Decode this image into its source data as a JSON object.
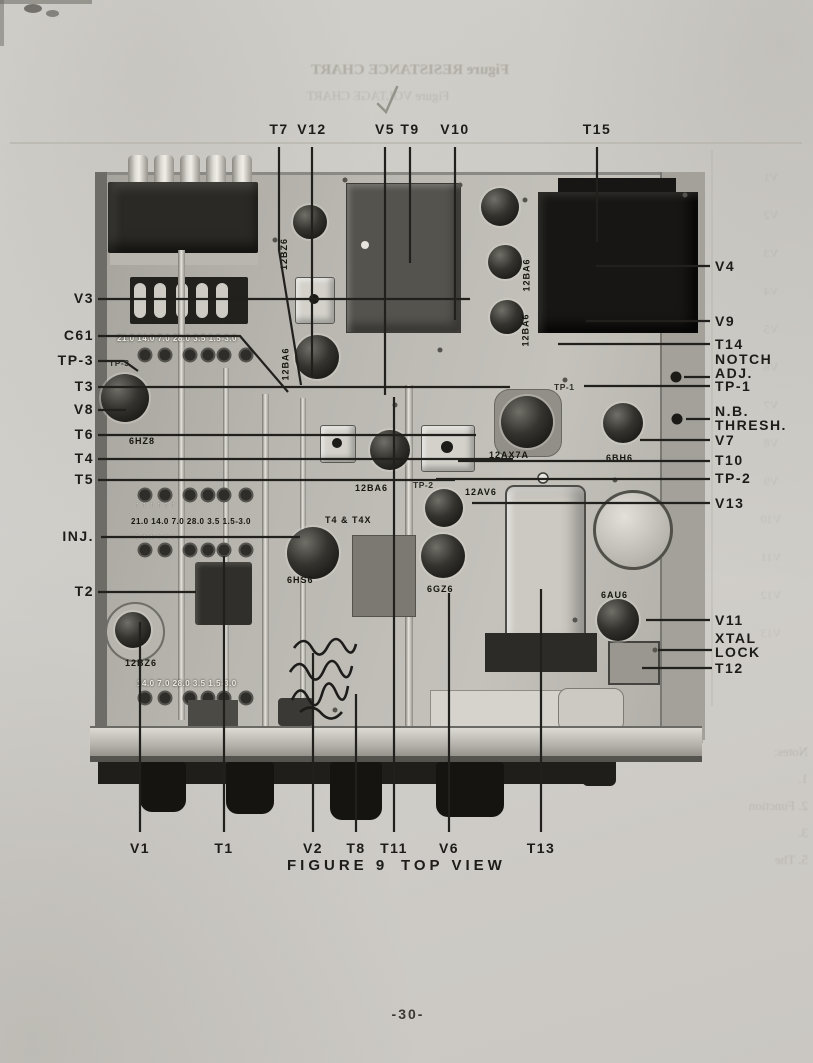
{
  "page": {
    "number": "-30-",
    "caption": {
      "figure": "FIGURE 9",
      "view": "TOP VIEW"
    }
  },
  "bleedthrough": {
    "title1": "Figure    RESISTANCE CHART",
    "title2": "Figure    VOLTAGE CHART",
    "notes": "Notes:\n1.\n2.  Function\n3.\n5.  The",
    "tube_column": "V1\nV2\nV3\nV4\nV5\nV6\nV7\nV8\nV9\nV10\nV11\nV12\nV13"
  },
  "callouts": {
    "top": [
      {
        "label": "T7"
      },
      {
        "label": "V12"
      },
      {
        "label": "V5"
      },
      {
        "label": "T9"
      },
      {
        "label": "V10"
      },
      {
        "label": "T15"
      }
    ],
    "left": [
      {
        "label": "V3"
      },
      {
        "label": "C61"
      },
      {
        "label": "TP-3"
      },
      {
        "label": "T3"
      },
      {
        "label": "V8"
      },
      {
        "label": "T6"
      },
      {
        "label": "T4"
      },
      {
        "label": "T5"
      },
      {
        "label": "INJ."
      },
      {
        "label": "T2"
      }
    ],
    "right": [
      {
        "label": "V4"
      },
      {
        "label": "V9"
      },
      {
        "label": "T14"
      },
      {
        "label": "NOTCH\nADJ."
      },
      {
        "label": "TP-1"
      },
      {
        "label": "N.B.\nTHRESH."
      },
      {
        "label": "V7"
      },
      {
        "label": "T10"
      },
      {
        "label": "TP-2"
      },
      {
        "label": "V13"
      },
      {
        "label": "V11"
      },
      {
        "label": "XTAL\nLOCK"
      },
      {
        "label": "T12"
      }
    ],
    "bottom": [
      {
        "label": "V1"
      },
      {
        "label": "T1"
      },
      {
        "label": "V2"
      },
      {
        "label": "T8"
      },
      {
        "label": "T11"
      },
      {
        "label": "V6"
      },
      {
        "label": "T13"
      }
    ]
  },
  "photo": {
    "stencils": [
      {
        "id": "tube-12bz6-top",
        "text": "12BZ6"
      },
      {
        "id": "tube-12ba6-a",
        "text": "12BA6"
      },
      {
        "id": "tube-12ba6-b",
        "text": "12BA6"
      },
      {
        "id": "tube-12ba6-c",
        "text": "12BA6"
      },
      {
        "id": "tube-12ax7a",
        "text": "12AX7A"
      },
      {
        "id": "tube-6bh6",
        "text": "6BH6"
      },
      {
        "id": "tp1-stamp",
        "text": "TP-1"
      },
      {
        "id": "tp2-stamp",
        "text": "TP-2"
      },
      {
        "id": "tp3-stamp",
        "text": "TP-3"
      },
      {
        "id": "tube-12av6",
        "text": "12AV6"
      },
      {
        "id": "tube-12ba6-d",
        "text": "12BA6"
      },
      {
        "id": "t4-t4x",
        "text": "T4 & T4X"
      },
      {
        "id": "tube-6hs6",
        "text": "6HS6"
      },
      {
        "id": "tube-6hz8",
        "text": "6HZ8"
      },
      {
        "id": "tube-6gz6",
        "text": "6GZ6"
      },
      {
        "id": "tube-6au6",
        "text": "6AU6"
      },
      {
        "id": "tube-12bz6-bottom",
        "text": "12BZ6"
      },
      {
        "id": "dial-row-1",
        "text": "21.0 14.0  7.0  28.0  3.5 1.5-3.0"
      },
      {
        "id": "dial-row-2",
        "text": "21.0 14.0  7.0  28.0  3.5 1.5-3.0"
      },
      {
        "id": "dial-row-3",
        "text": "14.0  7.0  28.0  3.5  1.5-3.0"
      },
      {
        "id": "dial-arrows-top",
        "text": "↑     ↑      ↑     ↑     ↑     ↑"
      },
      {
        "id": "dial-arrows-bottom",
        "text": "↑     ↑      ↑     ↑     ↑     ↑"
      }
    ]
  }
}
